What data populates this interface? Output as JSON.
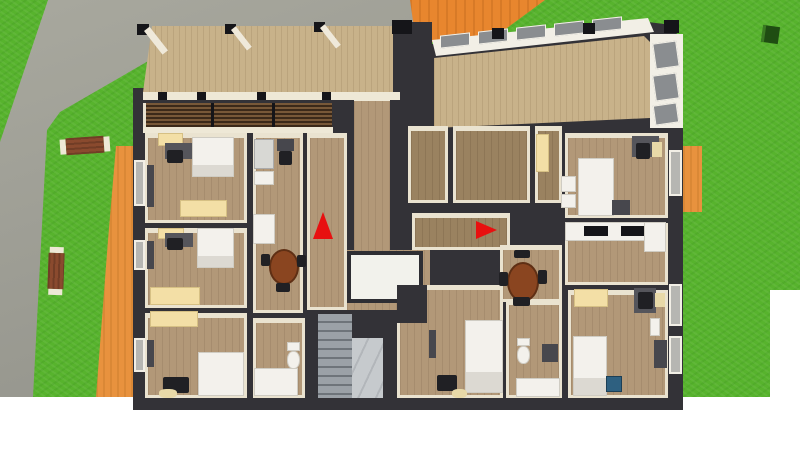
{
  "scene": {
    "type": "3d-floor-plan-top-down-render",
    "visible_text": "none",
    "description": "Bird's-eye 3D render of a residential floor: three bedrooms on the left, central hall with stairwell, two kitchens, two bathrooms, two bedrooms on the right, roofed balcony and glazed sunroom on top, lawn with paths and benches around the building"
  },
  "palette": {
    "background": "#ffffff",
    "grass": "#57b32d",
    "pavement_gray": "#9d9d95",
    "walkway_orange": "#e8923e",
    "roof_orange": "#e8862e",
    "wall_dark": "#333237",
    "wall_face_cream": "#eae3d0",
    "floor_wood": "#b29878",
    "floor_wood_dark": "#9a8260",
    "deck_wood": "#ccb68e",
    "furniture_white": "#f3f1ec",
    "wardrobe_cream": "#f3dfa6",
    "table_brown": "#8a4520",
    "stairs_gray": "#8c9196",
    "marker_red": "#e81010",
    "bin_blue": "#2e6080",
    "bin_green": "#1f4d12"
  },
  "outdoor_objects": [
    "lawn",
    "gray-pavement-path",
    "orange-walkway-left",
    "orange-walkway-right",
    "orange-roof-section",
    "garden-bench-horizontal",
    "garden-bench-vertical",
    "green-waste-bin",
    "wooden-balcony-deck",
    "deck-railing-posts"
  ],
  "rooms": [
    {
      "name": "bedroom-left-top",
      "furniture": [
        "shelf",
        "desk",
        "chair",
        "bed",
        "wardrobe",
        "tv-panel"
      ]
    },
    {
      "name": "bedroom-left-middle",
      "furniture": [
        "shelf",
        "desk",
        "chair",
        "bed",
        "wardrobe",
        "tv-panel"
      ]
    },
    {
      "name": "bedroom-left-bottom",
      "furniture": [
        "wardrobe",
        "bed",
        "chair",
        "pouf",
        "tv-panel"
      ]
    },
    {
      "name": "kitchen-left",
      "furniture": [
        "fridge",
        "cabinets",
        "chair",
        "round-dining-table",
        "chairs"
      ]
    },
    {
      "name": "bathroom-left",
      "furniture": [
        "vanity",
        "toilet"
      ]
    },
    {
      "name": "stairwell",
      "furniture": [
        "stair-flight",
        "landing"
      ]
    },
    {
      "name": "hall",
      "furniture": [
        "white-floor-opening"
      ]
    },
    {
      "name": "small-room-middle-1",
      "furniture": []
    },
    {
      "name": "small-room-middle-2",
      "furniture": []
    },
    {
      "name": "small-room-middle-3",
      "furniture": [
        "tall-cabinet"
      ]
    },
    {
      "name": "bedroom-center-bottom",
      "furniture": [
        "bed",
        "chair",
        "pouf",
        "tv-panel"
      ]
    },
    {
      "name": "bathroom-right",
      "furniture": [
        "toilet",
        "vanity",
        "shelf"
      ]
    },
    {
      "name": "dining-nook",
      "furniture": [
        "round-dining-table",
        "chairs"
      ]
    },
    {
      "name": "bedroom-right-top",
      "furniture": [
        "bed",
        "shelves",
        "nightstand",
        "desk",
        "chair",
        "seat"
      ]
    },
    {
      "name": "kitchen-right",
      "furniture": [
        "counter",
        "cooktop",
        "cooktop",
        "cabinet"
      ]
    },
    {
      "name": "bedroom-right-bottom",
      "furniture": [
        "wardrobe",
        "desk",
        "chair",
        "bed",
        "blue-bin",
        "radiator",
        "shelf"
      ]
    },
    {
      "name": "sunroom",
      "furniture": []
    }
  ],
  "markers": [
    {
      "name": "red-arrow-marker-up",
      "direction": "up",
      "color": "#e81010"
    },
    {
      "name": "red-arrow-marker-right",
      "direction": "right",
      "color": "#e81010"
    }
  ]
}
